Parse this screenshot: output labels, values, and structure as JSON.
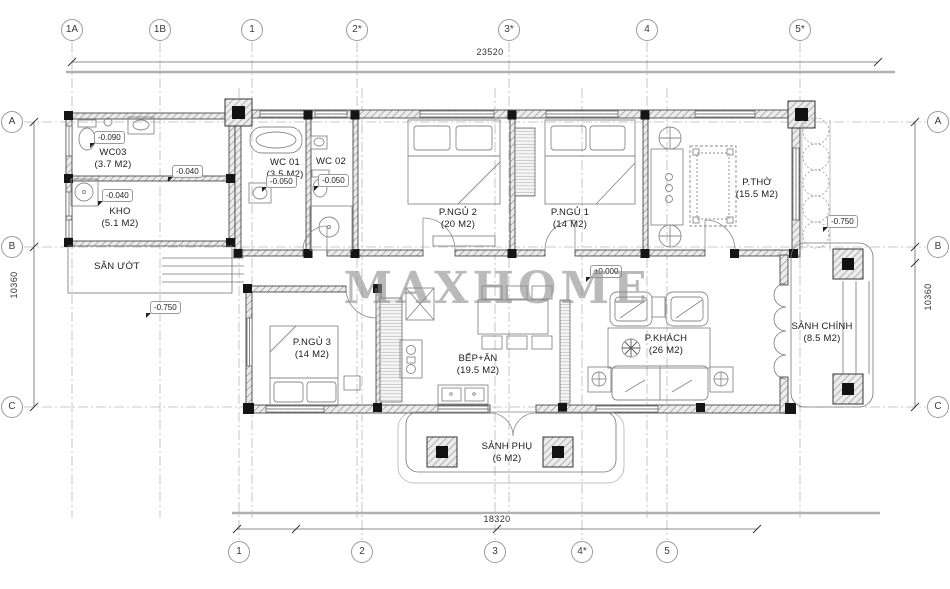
{
  "watermark": "MAXHOME",
  "grid": {
    "top": [
      {
        "label": "1A"
      },
      {
        "label": "1B"
      },
      {
        "label": "1"
      },
      {
        "label": "2*"
      },
      {
        "label": "3*"
      },
      {
        "label": "4"
      },
      {
        "label": "5*"
      }
    ],
    "bottom": [
      {
        "label": "1"
      },
      {
        "label": "2"
      },
      {
        "label": "3"
      },
      {
        "label": "4*"
      },
      {
        "label": "5"
      }
    ],
    "left": [
      {
        "label": "A"
      },
      {
        "label": "B"
      },
      {
        "label": "C"
      }
    ],
    "right": [
      {
        "label": "A"
      },
      {
        "label": "B"
      },
      {
        "label": "C"
      }
    ]
  },
  "dimensions": {
    "top": "23520",
    "bottom": "18320",
    "left": "10360",
    "right": "10360"
  },
  "rooms": [
    {
      "id": "wc03",
      "name": "WC03",
      "area": "(3.7 M2)"
    },
    {
      "id": "kho",
      "name": "KHO",
      "area": "(5.1 M2)"
    },
    {
      "id": "san-uot",
      "name": "SÂN ƯỚT",
      "area": ""
    },
    {
      "id": "wc01",
      "name": "WC 01",
      "area": "(3.5 M2)"
    },
    {
      "id": "wc02",
      "name": "WC 02",
      "area": ""
    },
    {
      "id": "pngu2",
      "name": "P.NGỦ 2",
      "area": "(20 M2)"
    },
    {
      "id": "pngu1",
      "name": "P.NGỦ 1",
      "area": "(14 M2)"
    },
    {
      "id": "ptho",
      "name": "P.THỜ",
      "area": "(15.5 M2)"
    },
    {
      "id": "pngu3",
      "name": "P.NGỦ 3",
      "area": "(14 M2)"
    },
    {
      "id": "bepan",
      "name": "BẾP+ĂN",
      "area": "(19.5 M2)"
    },
    {
      "id": "pkhach",
      "name": "P.KHÁCH",
      "area": "(26 M2)"
    },
    {
      "id": "sanh-chinh",
      "name": "SẢNH CHÍNH",
      "area": "(8.5 M2)"
    },
    {
      "id": "sanh-phu",
      "name": "SẢNH PHỤ",
      "area": "(6 M2)"
    }
  ],
  "levels": [
    {
      "id": "wc03",
      "value": "-0.090"
    },
    {
      "id": "kho",
      "value": "-0.040"
    },
    {
      "id": "annex",
      "value": "-0.040"
    },
    {
      "id": "wc01",
      "value": "-0.050"
    },
    {
      "id": "wc02",
      "value": "-0.050"
    },
    {
      "id": "san-uot",
      "value": "-0.750"
    },
    {
      "id": "porch",
      "value": "-0.750"
    },
    {
      "id": "main",
      "value": "±0.000"
    }
  ],
  "colors": {
    "wall_stroke": "#333333",
    "grid_line": "#b8b8b8",
    "column_fill": "#151515",
    "text": "#1c1c1c"
  }
}
